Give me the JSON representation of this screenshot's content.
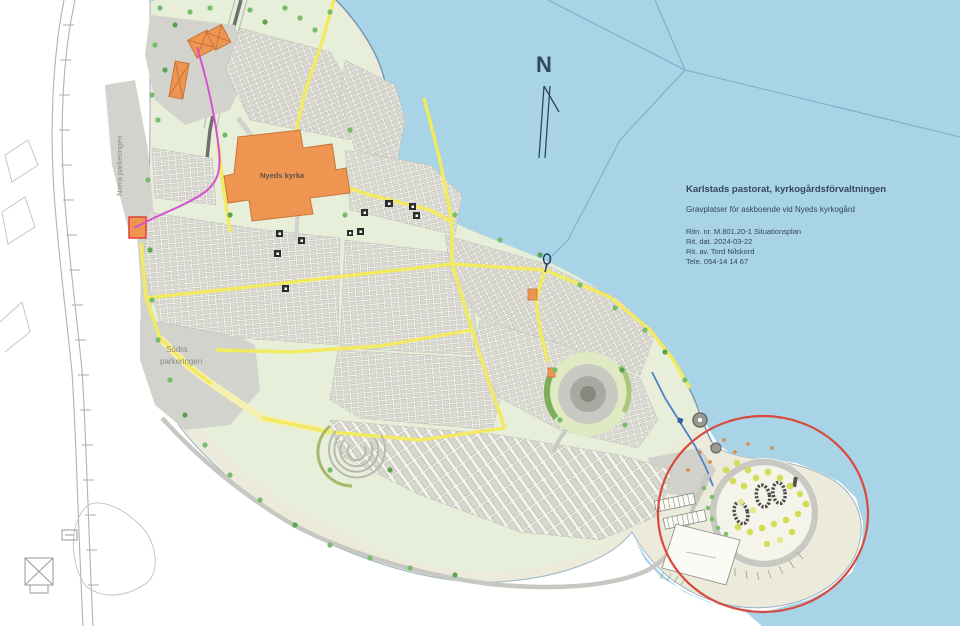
{
  "map": {
    "title_block": {
      "org": "Karlstads pastorat, kyrkogårdsförvaltningen",
      "subtitle": "Gravplatser för askboende vid Nyeds kyrkogård",
      "drawing_no": "Ritn. nr. M.801.20-1 Situationsplan",
      "date": "Rit. dat. 2024-03-22",
      "author": "Rit. av. Tord Nilskord",
      "phone": "Tele. 054-14 14 67"
    },
    "labels": {
      "church": "Nyeds kyrka",
      "south_parking": [
        "Södra",
        "parkeringen"
      ],
      "north_parking": "Norra parkeringen",
      "north_arrow": "N"
    },
    "colors": {
      "water": "#a9d3e6",
      "shore_land": "#eceadb",
      "lawn": "#e7eed9",
      "parking_gray": "#d3d3cd",
      "path_yellow": "#f2ea5f",
      "building_orange": "#ef9552",
      "highlight_red": "#d84a3e",
      "route_magenta": "#d94fd0",
      "pipe_blue": "#4f82c8"
    }
  }
}
